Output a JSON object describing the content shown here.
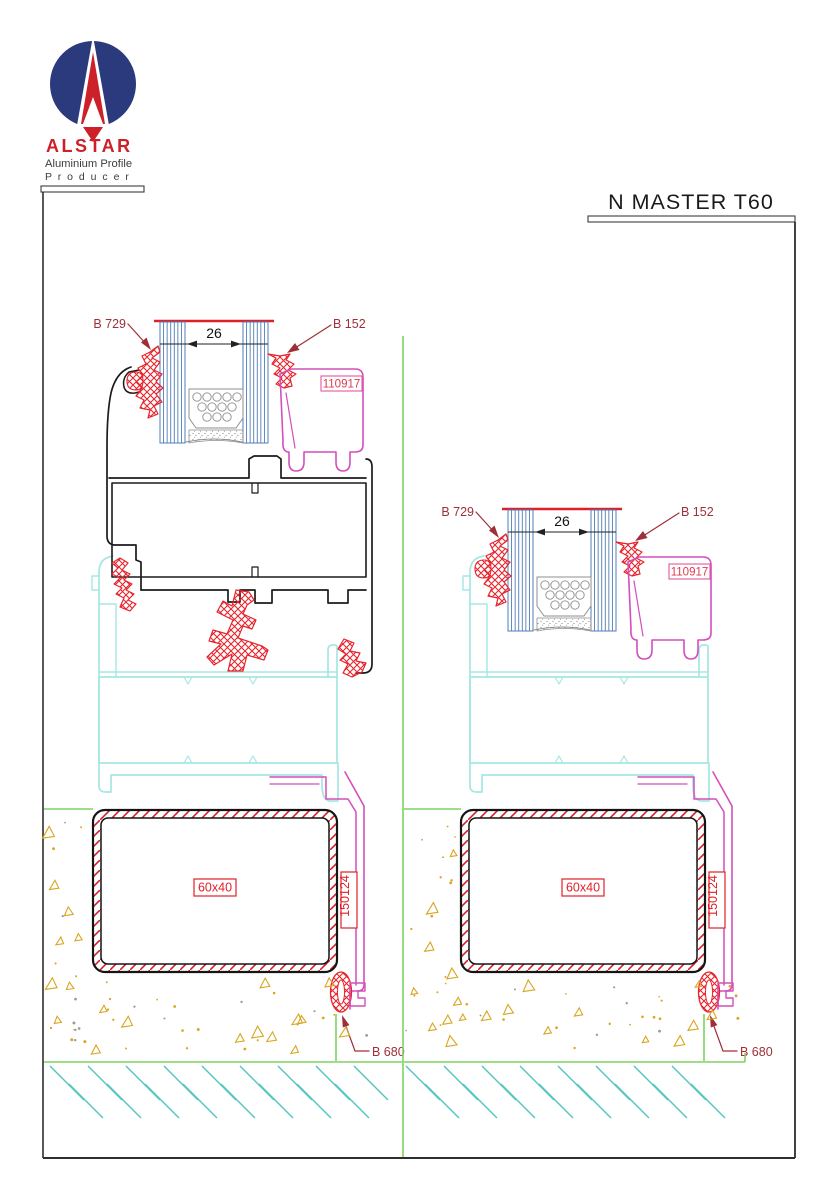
{
  "page": {
    "title": "N MASTER T60"
  },
  "logo": {
    "brand": "ALSTAR",
    "tagline_line1": "Aluminium Profile",
    "tagline_line2": "P r o d u c e r"
  },
  "drawings": [
    {
      "name": "section-with-sash",
      "labels": {
        "gasket_left": "B 729",
        "gasket_right": "B 152",
        "glazing_width": "26",
        "bead_profile": "110917",
        "steel_tube": "60x40",
        "subframe_profile": "150124",
        "bottom_gasket": "B 680"
      }
    },
    {
      "name": "section-fixed-light",
      "labels": {
        "gasket_left": "B 729",
        "gasket_right": "B 152",
        "glazing_width": "26",
        "bead_profile": "110917",
        "steel_tube": "60x40",
        "subframe_profile": "150124",
        "bottom_gasket": "B 680"
      }
    }
  ],
  "colors": {
    "profile_black": "#1b1b1b",
    "gasket_red": "#e8242c",
    "glass_blue": "#4f7cb8",
    "frame_cyan": "#a5e7e3",
    "bead_magenta": "#d44ebc",
    "bead_box_pink": "#e8559a",
    "ground_green": "#7fd463",
    "soil_teal": "#52c6bf",
    "concrete_gold": "#d9a520",
    "label_dark_red": "#9e2f38",
    "label_red": "#e02028",
    "logo_navy": "#2b3a7d",
    "logo_red": "#cc2128",
    "frame_line": "#2e2e2e"
  }
}
